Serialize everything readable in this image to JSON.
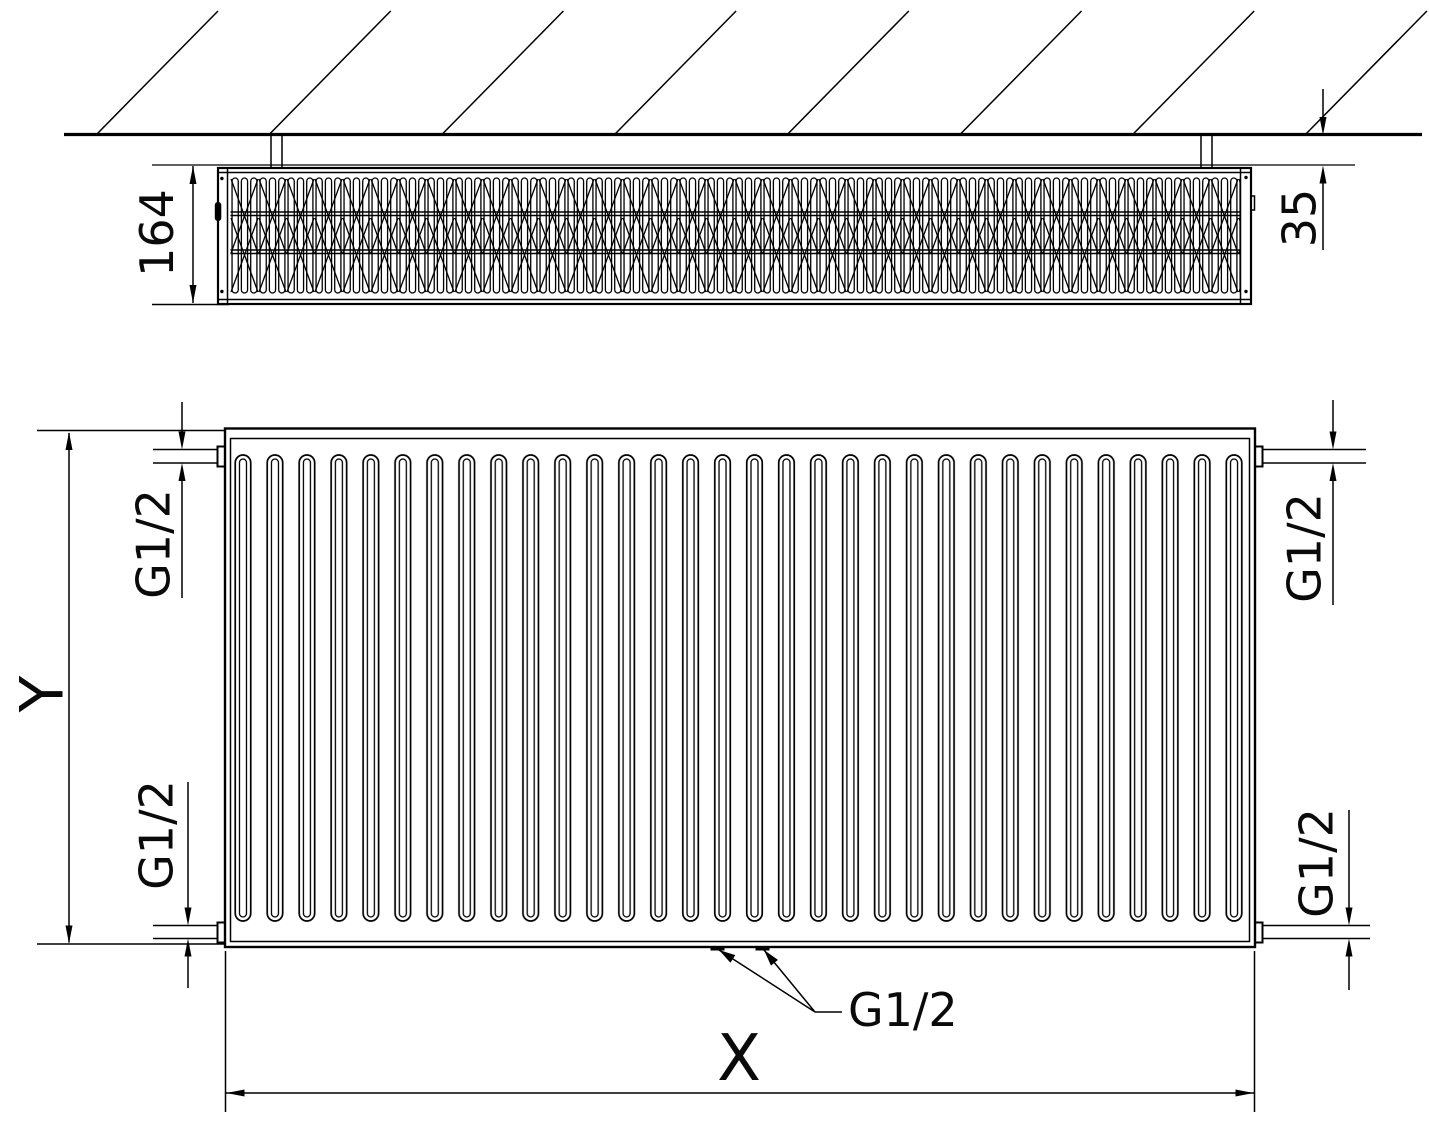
{
  "drawing": {
    "title": "radiator-dimension-drawing",
    "dimensions": {
      "total_depth": "164",
      "wall_distance": "35",
      "height": "Y",
      "length": "X",
      "connection_thread": "G1/2"
    },
    "colors": {
      "line": "#000000",
      "background": "#ffffff",
      "text": "#0a0a0a"
    }
  }
}
